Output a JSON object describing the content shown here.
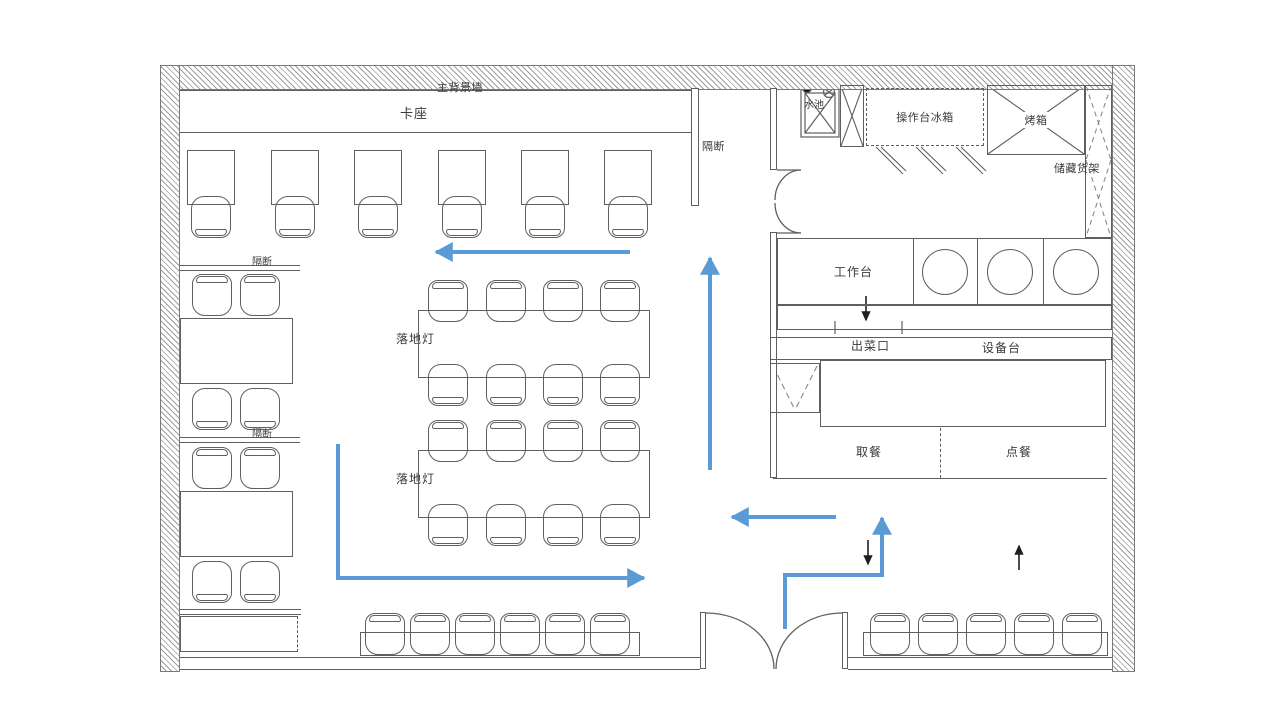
{
  "colors": {
    "line": "#5f5f5f",
    "wall_hatch": "#9e9e9e",
    "flow_arrow_blue": "#5b9bd5",
    "direction_arrow_black": "#1f1f1f"
  },
  "labels": {
    "main_background_wall": "主背景墙",
    "booth_seating": "卡座",
    "partition_right": "隔断",
    "partition_left_top": "隔断",
    "partition_left_bottom": "隔断",
    "floor_lamp_top": "落地灯",
    "floor_lamp_bottom": "落地灯",
    "sink": "水池",
    "prep_counter_fridge": "操作台冰箱",
    "oven": "烤箱",
    "storage_rack": "储藏货架",
    "work_counter": "工作台",
    "serving_window": "出菜口",
    "equipment_counter": "设备台",
    "pickup_area": "取餐",
    "order_area": "点餐"
  }
}
